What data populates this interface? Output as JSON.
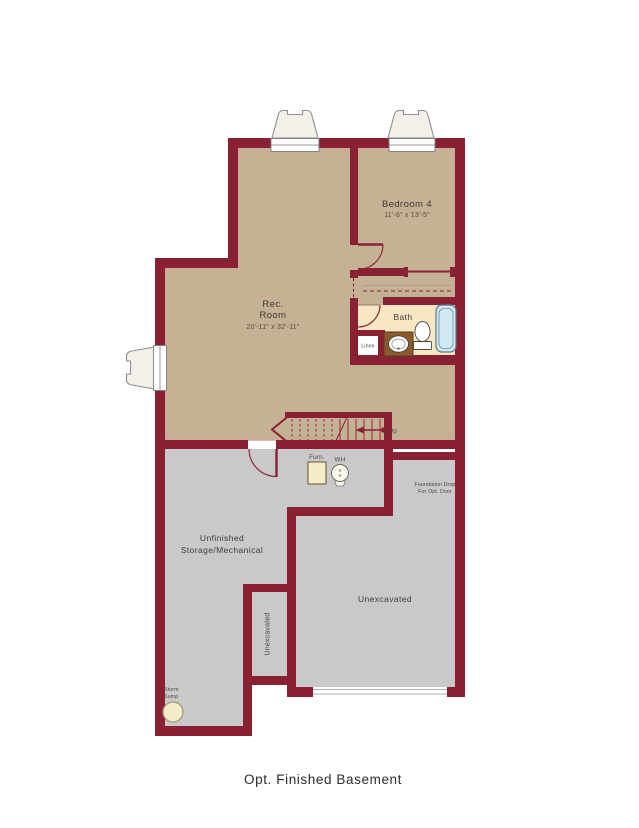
{
  "page_title": "Opt. Finished Basement",
  "plan": {
    "rooms": {
      "rec_room": {
        "name_line1": "Rec.",
        "name_line2": "Room",
        "dimensions": "20'-11\" x 32'-11\""
      },
      "bedroom_4": {
        "name": "Bedroom 4",
        "dimensions": "11'-6\" x 13'-5\""
      },
      "bath": {
        "name": "Bath"
      },
      "linen": {
        "name": "Linen"
      },
      "unfinished_storage": {
        "name_line1": "Unfinished",
        "name_line2": "Storage/Mechanical"
      },
      "unexcavated_main": {
        "name": "Unexcavated"
      },
      "unexcavated_strip": {
        "name": "Unexcavated"
      }
    },
    "annotations": {
      "up": "Up",
      "furnace": "Furn.",
      "water_heater": "WH",
      "storm_sump_line1": "Storm",
      "storm_sump_line2": "Sump",
      "foundation_drop_line1": "Foundation Drop",
      "foundation_drop_line2": "For Opt. Door"
    },
    "colors": {
      "wall": "#8a2133",
      "finished_floor": "#c5b295",
      "unfinished_floor": "#c9c9ca",
      "bath_floor": "#f7e7c3",
      "tub": "#cfe8f3",
      "vanity": "#8a5b2d",
      "equipment_cream": "#f3edc7",
      "window_well": "#f3efe9"
    }
  }
}
